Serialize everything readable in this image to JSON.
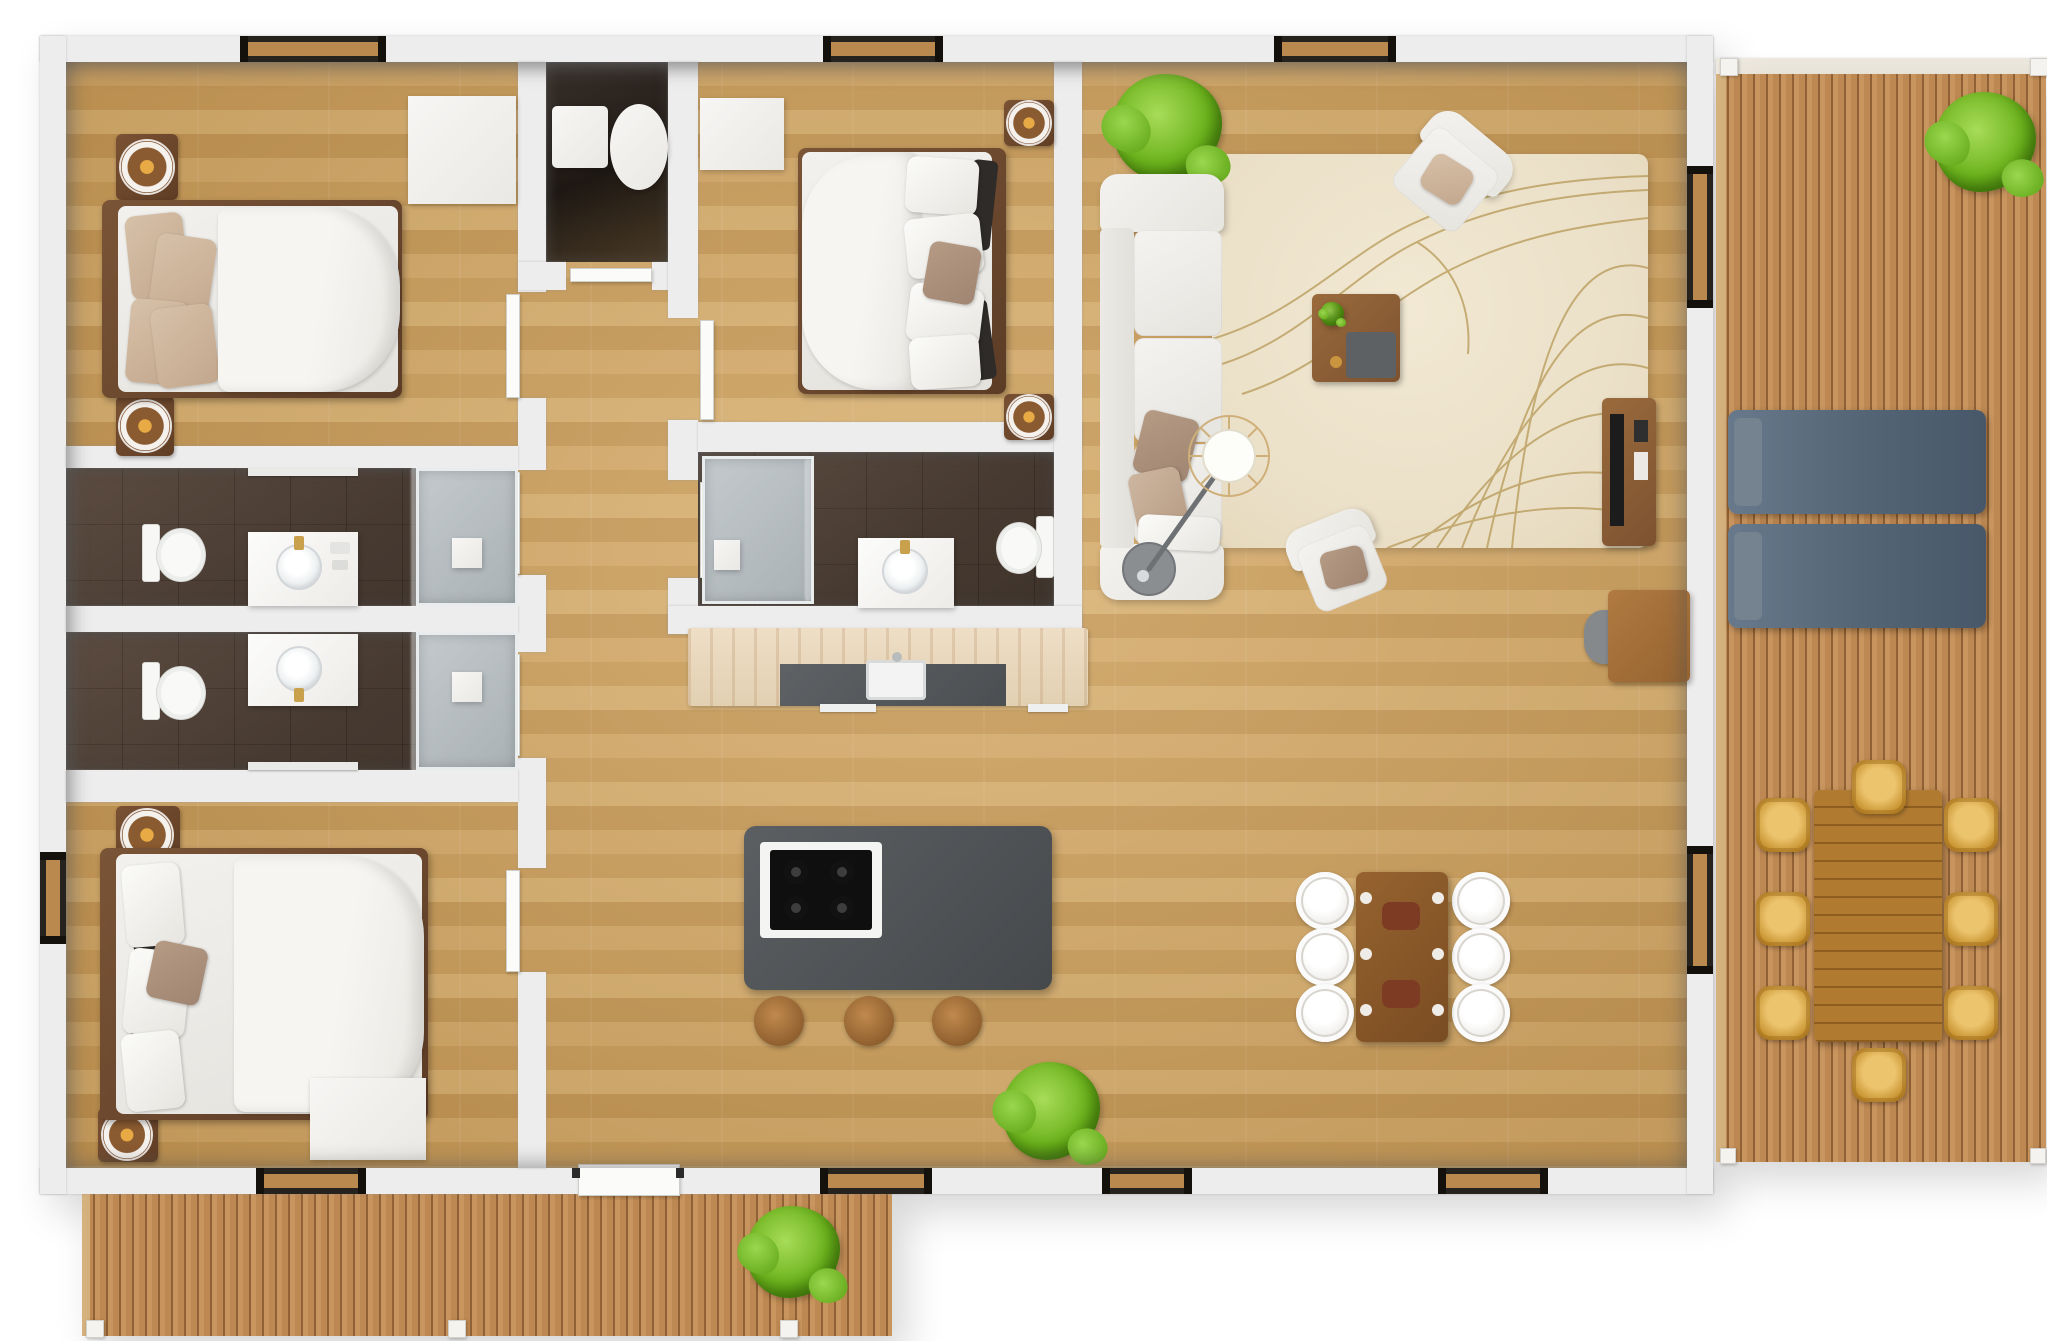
{
  "scene": {
    "type": "3d-floor-plan-render",
    "view": "top-down",
    "description": "Top-down 3D render of a 3-bedroom, 3-bathroom house with open kitchen/living/dining area, side deck and rear porch"
  },
  "palette": {
    "wall": "#ededed",
    "wood": "#c99e5e",
    "tile": "#473a31",
    "trav": "#e2d0b2",
    "charcoal": "#46494c",
    "bedframe": "#5c3c26",
    "rug": "#eadfc6",
    "rugline": "#b3944f",
    "deck": "#bd8852",
    "lounger": "#536474",
    "wicker": "#c7922f",
    "green": "#6cb31c",
    "gold": "#c9a04c"
  },
  "rooms": {
    "bedroom1": {
      "name": "Bedroom 1",
      "furniture": [
        "double bed",
        "2 round nightstands with lamps",
        "white dresser",
        "window"
      ]
    },
    "bedroom2": {
      "name": "Bedroom 2 (ensuite)",
      "furniture": [
        "double bed",
        "2 nightstands with lamps",
        "white wardrobe",
        "window"
      ]
    },
    "bedroom3": {
      "name": "Bedroom 3",
      "furniture": [
        "double bed",
        "2 nightstands with lamps",
        "white wardrobe",
        "2 windows"
      ]
    },
    "bathroom1": {
      "name": "Bathroom 1",
      "furniture": [
        "toilet",
        "vanity with round sink",
        "walk-in glass shower"
      ]
    },
    "bathroom2": {
      "name": "Bathroom 2",
      "furniture": [
        "toilet",
        "vanity with round sink",
        "walk-in glass shower"
      ]
    },
    "ensuite": {
      "name": "Ensuite bathroom",
      "furniture": [
        "toilet",
        "vanity with round sink",
        "walk-in glass shower"
      ]
    },
    "utility": {
      "name": "Utility closet",
      "furniture": [
        "washing machine",
        "water heater cylinder"
      ]
    },
    "hallway": {
      "name": "Hallway",
      "furniture": [
        "doors to bedrooms and bathrooms",
        "glazed rear entry door"
      ]
    },
    "kitchen": {
      "name": "Kitchen",
      "furniture": [
        "travertine counter with dark inset and sink",
        "charcoal island with 4-burner cooktop",
        "3 wooden bar stools"
      ]
    },
    "dining": {
      "name": "Dining area",
      "furniture": [
        "wood table with red-brown centerpieces",
        "6 white round chairs"
      ]
    },
    "living": {
      "name": "Living room",
      "furniture": [
        "white 3-seat sofa with pillows",
        "2 white armchairs",
        "wood coffee table with tray",
        "arc floor lamp",
        "patterned area rug",
        "media sideboard",
        "desk with chair",
        "2 potted plants"
      ]
    },
    "sideDeck": {
      "name": "Side deck",
      "furniture": [
        "2 slate-blue sun loungers",
        "outdoor wood dining table",
        "8 wicker chairs",
        "potted plant",
        "corner posts"
      ]
    },
    "porch": {
      "name": "Rear porch",
      "furniture": [
        "potted plant",
        "posts"
      ]
    }
  },
  "counts": {
    "bedrooms": 3,
    "bathrooms": 3,
    "windows": 10,
    "plants": 4,
    "decks": 2
  }
}
